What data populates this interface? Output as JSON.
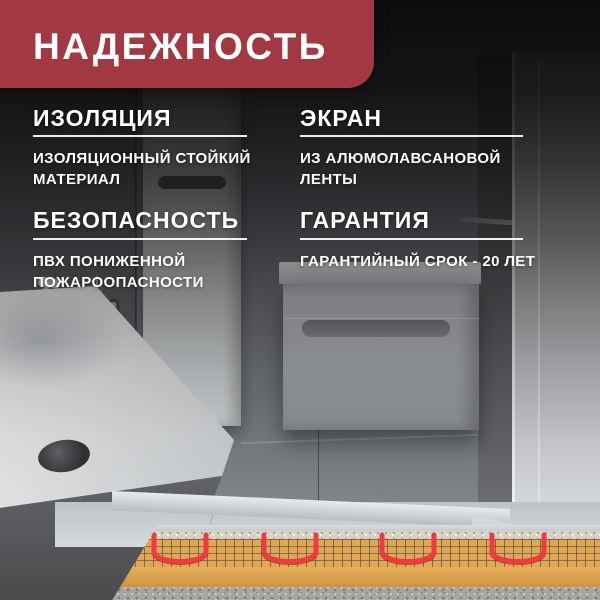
{
  "banner": {
    "title": "НАДЕЖНОСТЬ"
  },
  "features": [
    {
      "heading": "ИЗОЛЯЦИЯ",
      "body": "ИЗОЛЯЦИОННЫЙ СТОЙКИЙ МАТЕРИАЛ"
    },
    {
      "heading": "ЭКРАН",
      "body": "ИЗ АЛЮМОЛАВСАНОВОЙ ЛЕНТЫ"
    },
    {
      "heading": "БЕЗОПАСНОСТЬ",
      "body": "ПВХ ПОНИЖЕННОЙ ПОЖАРООПАСНОСТИ"
    },
    {
      "heading": "ГАРАНТИЯ",
      "body": "ГАРАНТИЙНЫЙ СРОК - 20 ЛЕТ"
    }
  ],
  "colors": {
    "banner_red": "#a23841",
    "cable_red": "#ee3a40",
    "mat_yellow": "#e0a854",
    "text_white": "#ffffff"
  }
}
